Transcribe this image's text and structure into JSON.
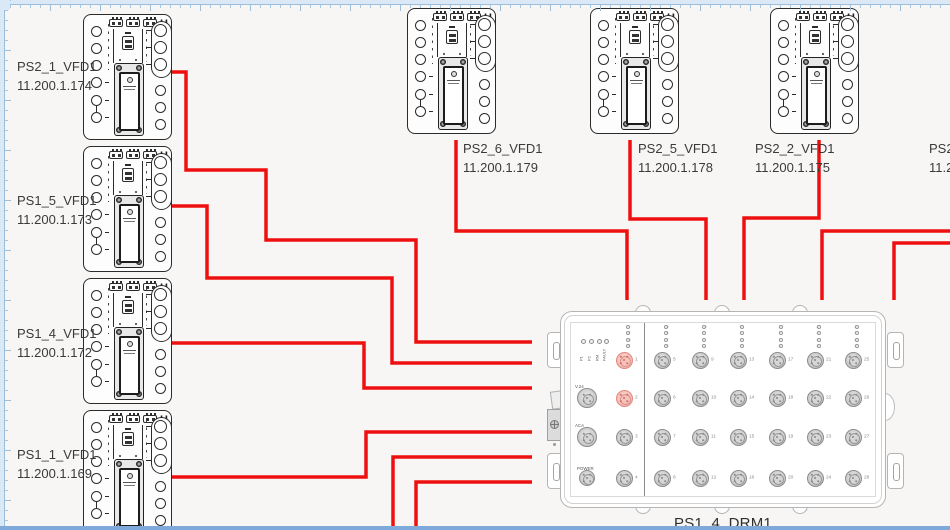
{
  "colors": {
    "canvas_bg": "#f7f6f4",
    "cable": "#ee1010",
    "highlighted_port": "#f0b4ab",
    "ruler": "#9bbedd",
    "bottom_bar": "#7fa9d9",
    "device_stroke": "#2b2b2b",
    "drm_stroke": "#b5b5b5",
    "label_text": "#3a3a3a"
  },
  "vfd_logo": "H",
  "vfd_devices": [
    {
      "name": "PS2_1_VFD1",
      "ip": "11.200.1.174",
      "x": 83,
      "y": 14,
      "label_x": 17,
      "label_y": 58
    },
    {
      "name": "PS1_5_VFD1",
      "ip": "11.200.1.173",
      "x": 83,
      "y": 146,
      "label_x": 17,
      "label_y": 192
    },
    {
      "name": "PS1_4_VFD1",
      "ip": "11.200.1.172",
      "x": 83,
      "y": 278,
      "label_x": 17,
      "label_y": 325
    },
    {
      "name": "PS1_1_VFD1",
      "ip": "11.200.1.169",
      "x": 83,
      "y": 410,
      "label_x": 17,
      "label_y": 446
    },
    {
      "name": "PS2_6_VFD1",
      "ip": "11.200.1.179",
      "x": 407,
      "y": 8,
      "label_x": 463,
      "label_y": 140
    },
    {
      "name": "PS2_5_VFD1",
      "ip": "11.200.1.178",
      "x": 590,
      "y": 8,
      "label_x": 638,
      "label_y": 140
    },
    {
      "name": "PS2_2_VFD1",
      "ip": "11.200.1.175",
      "x": 770,
      "y": 8,
      "label_x": 755,
      "label_y": 140
    }
  ],
  "partial_device": {
    "name": "PS2_",
    "ip": "11.2",
    "label_x": 929,
    "label_y": 140
  },
  "drm": {
    "label": "PS1_4_DRM1",
    "status_leds": [
      "P1",
      "P2",
      "RM",
      "FAULT"
    ],
    "side_ports": [
      "V.24",
      "ACA",
      "POWER"
    ],
    "led_groups": [
      [
        1,
        2,
        3,
        4
      ],
      [
        5,
        6,
        7,
        8
      ],
      [
        9,
        10,
        11,
        12
      ],
      [
        13,
        14,
        15,
        16
      ],
      [
        17,
        18,
        19,
        20
      ],
      [
        21,
        22,
        23,
        24
      ],
      [
        25,
        26,
        27,
        28
      ]
    ],
    "ports": [
      1,
      2,
      3,
      4,
      5,
      6,
      7,
      8,
      9,
      10,
      11,
      12,
      13,
      14,
      15,
      16,
      17,
      18,
      19,
      20,
      21,
      22,
      23,
      24,
      25,
      26,
      27,
      28
    ],
    "highlighted_ports": [
      1,
      2
    ]
  },
  "cables": [
    {
      "from": "PS2_1_VFD1",
      "points": [
        [
          172,
          72
        ],
        [
          186,
          72
        ],
        [
          186,
          170
        ],
        [
          266,
          170
        ],
        [
          266,
          240
        ],
        [
          416,
          240
        ],
        [
          416,
          342
        ],
        [
          532,
          342
        ]
      ]
    },
    {
      "from": "PS1_5_VFD1",
      "points": [
        [
          172,
          206
        ],
        [
          207,
          206
        ],
        [
          207,
          278
        ],
        [
          392,
          278
        ],
        [
          392,
          363
        ],
        [
          532,
          363
        ]
      ]
    },
    {
      "from": "PS1_4_VFD1",
      "points": [
        [
          172,
          343
        ],
        [
          364,
          343
        ],
        [
          364,
          388
        ],
        [
          532,
          388
        ]
      ]
    },
    {
      "from": "PS1_1_VFD1",
      "points": [
        [
          172,
          477
        ],
        [
          366,
          477
        ],
        [
          366,
          432
        ],
        [
          532,
          432
        ]
      ]
    },
    {
      "from": "bottom-edge-1",
      "points": [
        [
          393,
          532
        ],
        [
          393,
          457
        ],
        [
          532,
          457
        ]
      ]
    },
    {
      "from": "bottom-edge-2",
      "points": [
        [
          416,
          532
        ],
        [
          416,
          482
        ],
        [
          532,
          482
        ]
      ]
    },
    {
      "from": "PS2_6_VFD1",
      "points": [
        [
          456,
          140
        ],
        [
          456,
          231
        ],
        [
          627,
          231
        ],
        [
          627,
          300
        ]
      ]
    },
    {
      "from": "PS2_5_VFD1",
      "points": [
        [
          630,
          140
        ],
        [
          630,
          219
        ],
        [
          706,
          219
        ],
        [
          706,
          300
        ]
      ]
    },
    {
      "from": "PS2_2_VFD1",
      "points": [
        [
          819,
          140
        ],
        [
          819,
          218
        ],
        [
          744,
          218
        ],
        [
          744,
          300
        ]
      ]
    },
    {
      "from": "right-edge-1",
      "points": [
        [
          952,
          231
        ],
        [
          822,
          231
        ],
        [
          822,
          300
        ]
      ]
    },
    {
      "from": "right-edge-2",
      "points": [
        [
          952,
          243
        ],
        [
          894,
          243
        ],
        [
          894,
          300
        ]
      ]
    }
  ]
}
